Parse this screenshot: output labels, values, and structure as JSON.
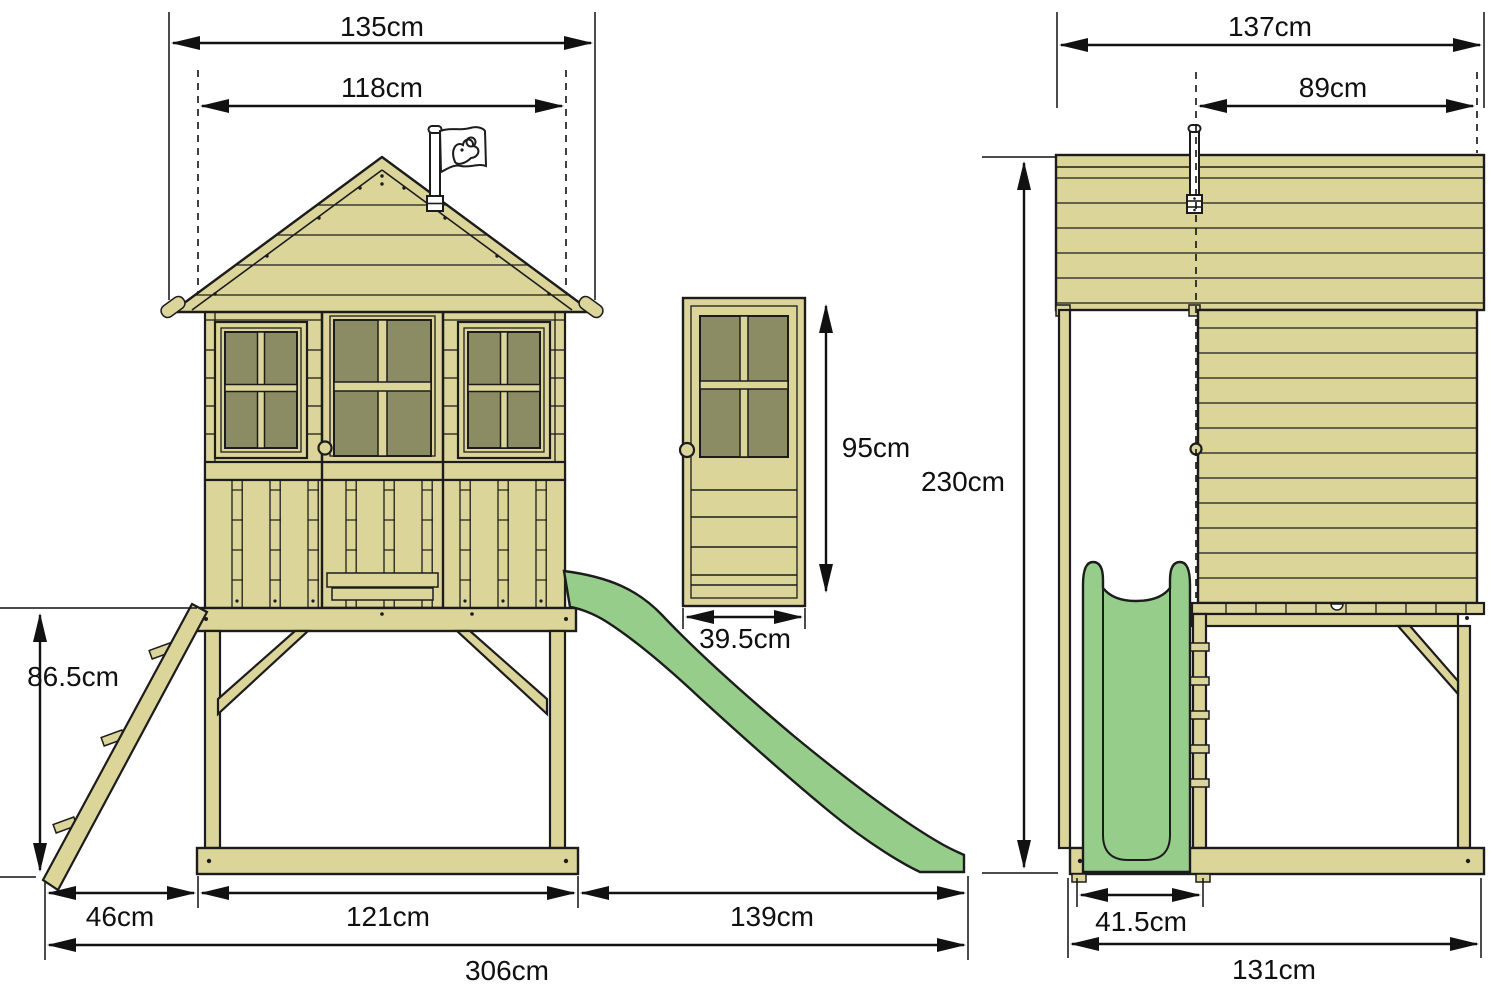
{
  "views": {
    "front": {
      "roof_width": "135cm",
      "body_width": "118cm",
      "platform_height": "86.5cm",
      "ladder_span": "46cm",
      "base_width": "121cm",
      "slide_span": "139cm",
      "total_width": "306cm"
    },
    "door_detail": {
      "door_height": "95cm",
      "door_width": "39.5cm"
    },
    "side": {
      "roof_depth": "137cm",
      "wall_depth": "89cm",
      "total_height": "230cm",
      "slide_width": "41.5cm",
      "base_depth": "131cm"
    }
  },
  "colors": {
    "background": "#ffffff",
    "wood": "#dcd59a",
    "window_pane": "#8b8c63",
    "slide_green": "#97cd8a",
    "outline": "#1c1c1c",
    "dimension_ink": "#111111",
    "flag_white": "#ffffff"
  },
  "icons": {
    "flag_logo": "tp-bird-flag-logo"
  }
}
